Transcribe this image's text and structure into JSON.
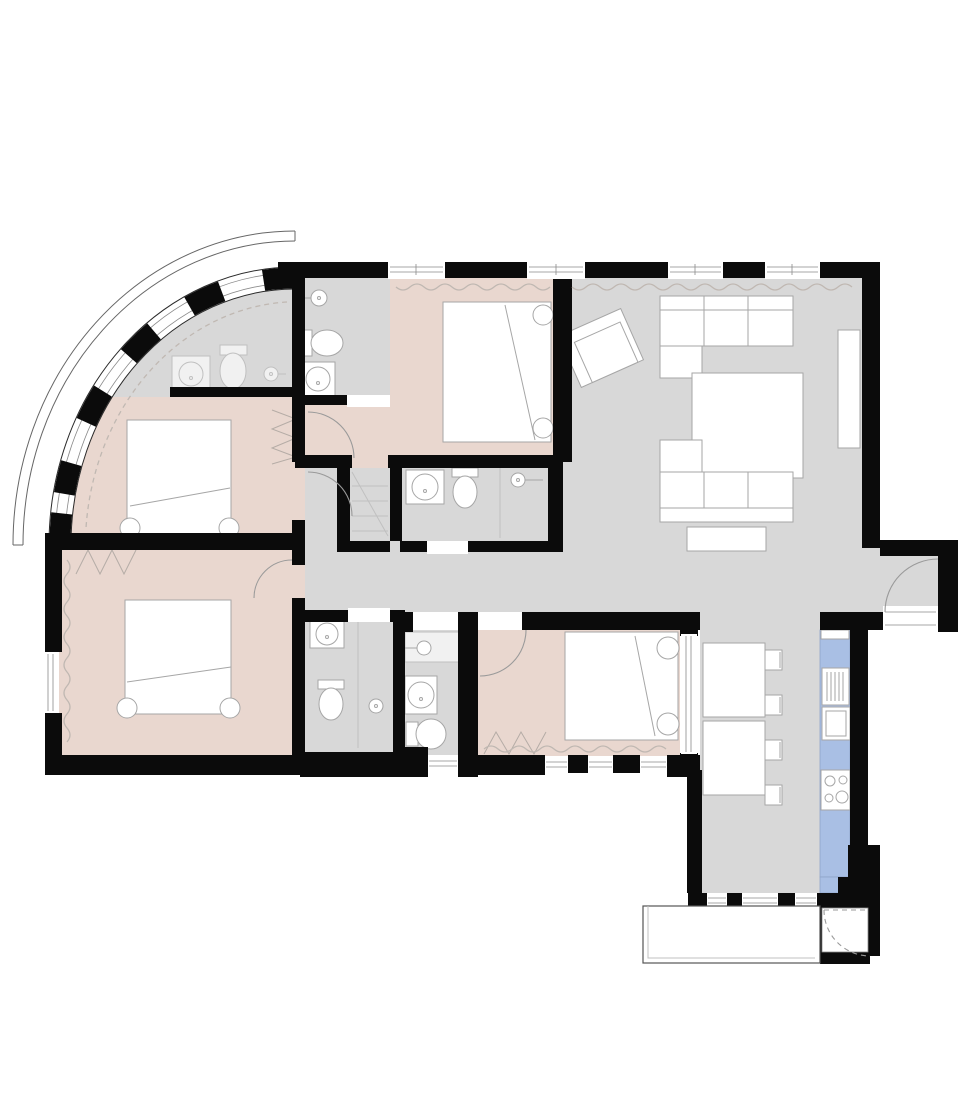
{
  "diagram_type": "apartment-floor-plan",
  "colors": {
    "background": "#ffffff",
    "wall": "#0b0b0b",
    "room_gray": "#d8d8d8",
    "room_pink": "#e9d7cf",
    "kitchen_blue": "#a9bfe4",
    "kitchen_blue_line": "#8fa3c8",
    "fixture_fill": "#ffffff",
    "fixture_stroke": "#a6a6a6",
    "faint_stroke": "#c0c0c0",
    "curtain": "#c0b8b2",
    "door_arc": "#9a9a9a",
    "window_line": "#8a8a8a",
    "outline": "#666666",
    "hatch": "#b5aca6"
  },
  "rooms": [
    {
      "id": "living-room",
      "floor": "gray",
      "furniture": [
        "corner sofa top",
        "corner sofa bottom",
        "coffee table / rug",
        "armchair (rotated)",
        "tv bench",
        "sideboard"
      ]
    },
    {
      "id": "hallway",
      "floor": "gray",
      "furniture": []
    },
    {
      "id": "entrance-nook",
      "floor": "gray",
      "furniture": [
        "entrance door with swing arc"
      ]
    },
    {
      "id": "kitchen-dining",
      "floor": "gray",
      "furniture": [
        "blue counter run",
        "sink with drainer",
        "oven",
        "cooktop 4 burners",
        "split dining table",
        "4 chairs"
      ]
    },
    {
      "id": "bedroom-top",
      "floor": "pink",
      "furniture": [
        "double bed",
        "2 pillows"
      ]
    },
    {
      "id": "bedroom-upper-left",
      "floor": "pink",
      "furniture": [
        "double bed",
        "2 pillows",
        "wardrobe hatch"
      ]
    },
    {
      "id": "bedroom-lower-left",
      "floor": "pink",
      "furniture": [
        "double bed",
        "2 pillows",
        "wardrobe hatch",
        "curtain wave"
      ]
    },
    {
      "id": "bedroom-bottom",
      "floor": "pink",
      "furniture": [
        "double bed",
        "2 pillows",
        "wardrobe hatch",
        "curtain wave",
        "door arc"
      ]
    },
    {
      "id": "bathroom-curved",
      "floor": "gray",
      "furniture": [
        "sink",
        "toilet",
        "shower head"
      ]
    },
    {
      "id": "bathroom-top",
      "floor": "gray",
      "furniture": [
        "shower head",
        "toilet",
        "sink"
      ]
    },
    {
      "id": "bathroom-central",
      "floor": "gray",
      "furniture": [
        "sink",
        "toilet",
        "shower head",
        "glass divider"
      ]
    },
    {
      "id": "bathroom-bottom-left",
      "floor": "gray",
      "furniture": [
        "sink",
        "toilet",
        "shower head",
        "glass divider"
      ]
    },
    {
      "id": "bathroom-bottom-right",
      "floor": "gray",
      "furniture": [
        "counter with tap",
        "round basin",
        "bathtub"
      ]
    },
    {
      "id": "closet",
      "floor": "gray",
      "furniture": [
        "shelves"
      ]
    },
    {
      "id": "balcony",
      "floor": "white",
      "furniture": [
        "balcony door with dashed swing arc"
      ]
    }
  ],
  "windows": {
    "top_wall": 4,
    "curved_facade_segments": 5,
    "bedroom_bottom_south": 3,
    "dining_south": 3,
    "left_wall": 1,
    "bathroom_south": 1,
    "bedroom_dining_partition": 1
  },
  "doors": [
    "entrance",
    "balcony (dashed)",
    "bedroom-bottom",
    "vestibule upper",
    "vestibule lower",
    "bedroom-lower-left"
  ]
}
